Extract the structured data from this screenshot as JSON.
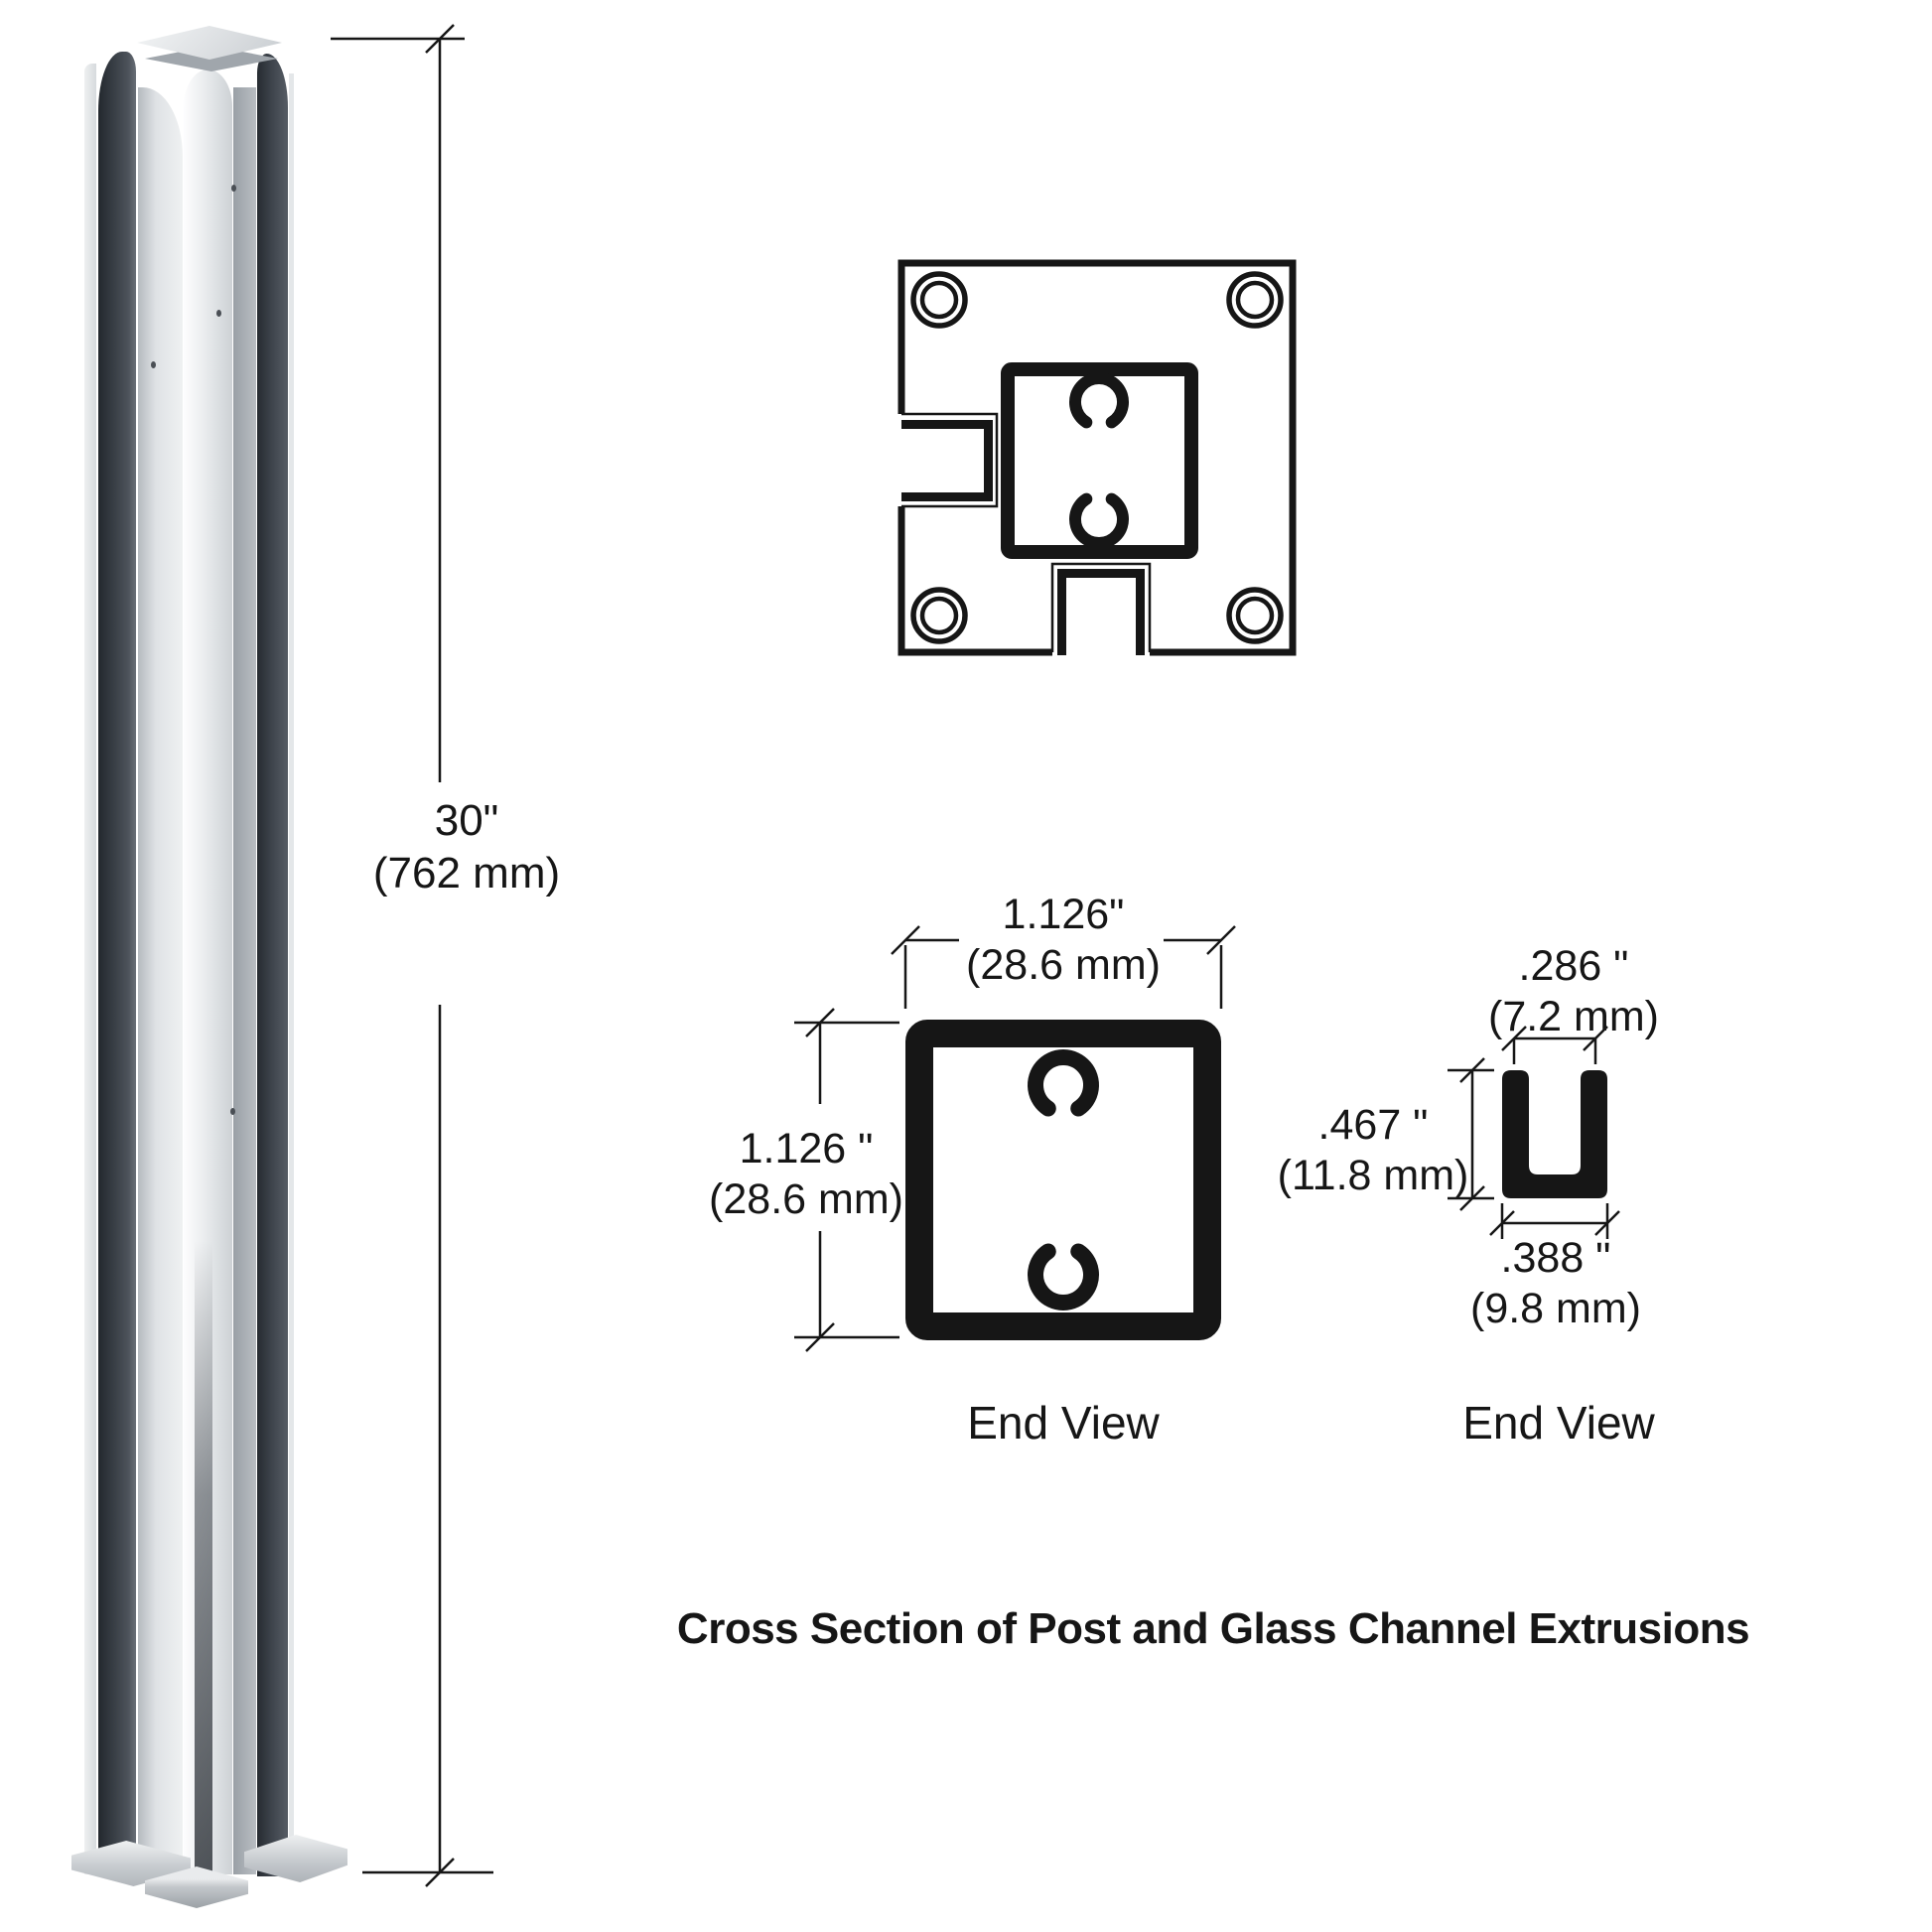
{
  "caption": "Cross Section of Post and Glass Channel Extrusions",
  "post_illustration": {
    "height_dim": {
      "inches": "30\"",
      "mm": "(762 mm)"
    }
  },
  "post_end_view": {
    "label": "End View",
    "width_dim": {
      "inches": "1.126\"",
      "mm": "(28.6 mm)"
    },
    "height_dim": {
      "inches": "1.126 \"",
      "mm": "(28.6 mm)"
    }
  },
  "channel_end_view": {
    "label": "End View",
    "opening_dim": {
      "inches": ".286 \"",
      "mm": "(7.2 mm)"
    },
    "height_dim": {
      "inches": ".467 \"",
      "mm": "(11.8 mm)"
    },
    "width_dim": {
      "inches": ".388 \"",
      "mm": "(9.8 mm)"
    }
  },
  "colors": {
    "line": "#161616",
    "aluminum_light": "#e9ebed",
    "aluminum_mid": "#c7cbcf",
    "channel_dark": "#3b4148",
    "background": "#ffffff"
  }
}
